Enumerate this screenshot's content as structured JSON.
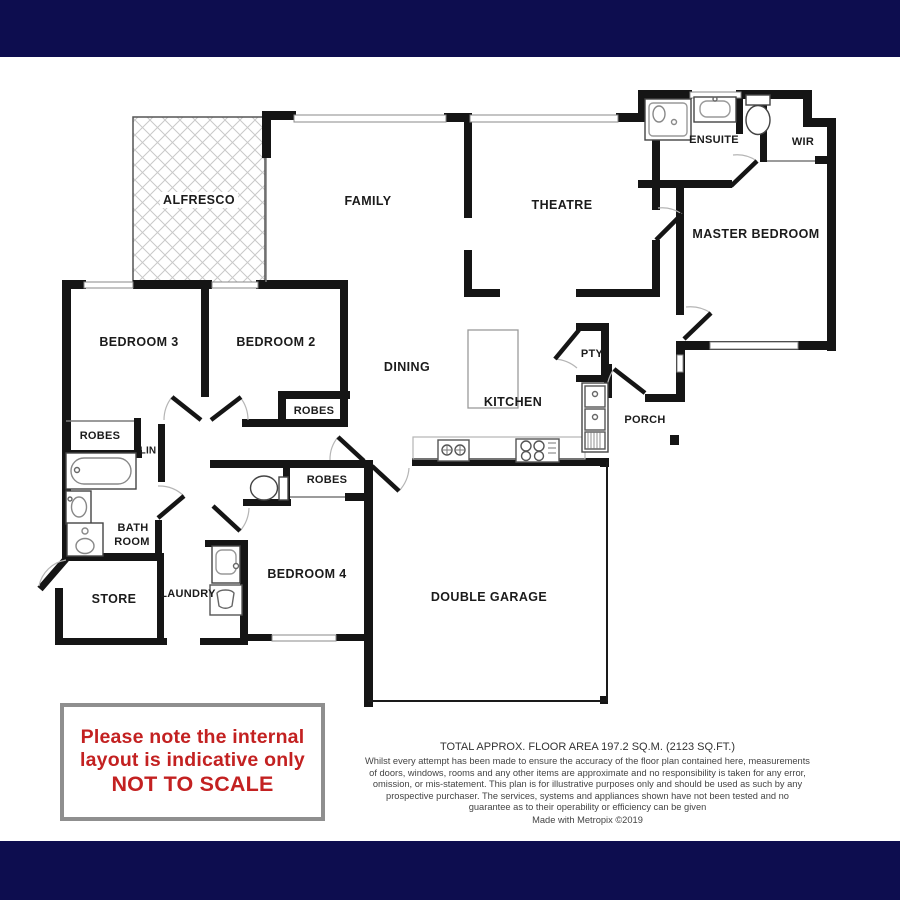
{
  "colors": {
    "banner": "#0d0d4f",
    "wall": "#151515",
    "notice_red": "#c32121",
    "notice_border": "#8f8f8f"
  },
  "rooms": {
    "alfresco": "ALFRESCO",
    "family": "FAMILY",
    "theatre": "THEATRE",
    "ensuite": "ENSUITE",
    "wir": "WIR",
    "master_bedroom": "MASTER BEDROOM",
    "bedroom3": "BEDROOM 3",
    "bedroom2": "BEDROOM 2",
    "dining": "DINING",
    "kitchen": "KITCHEN",
    "pty": "PTY",
    "porch": "PORCH",
    "robes_bed3": "ROBES",
    "robes_bed2": "ROBES",
    "robes_bed4": "ROBES",
    "lin": "LIN",
    "bath_line1": "BATH",
    "bath_line2": "ROOM",
    "store": "STORE",
    "laundry": "LAUNDRY",
    "bedroom4": "BEDROOM 4",
    "double_garage": "DOUBLE GARAGE"
  },
  "fixtures": [
    "bathtub",
    "shower",
    "vanity",
    "toilet",
    "kitchen-sink",
    "cooktop",
    "oven-tower",
    "kitchen-island",
    "laundry-tub",
    "washing-machine",
    "porch-post"
  ],
  "notice": {
    "line1": "Please note the internal",
    "line2": "layout is indicative only",
    "line3": "NOT TO SCALE"
  },
  "disclaimer": {
    "title": "TOTAL APPROX. FLOOR AREA 197.2 SQ.M. (2123 SQ.FT.)",
    "body": "Whilst every attempt has been made to ensure the accuracy of the floor plan contained here, measurements of doors, windows, rooms and any other items are approximate and no responsibility is taken for any error, omission, or mis-statement. This plan is for illustrative purposes only and should be used as such by any prospective purchaser. The services, systems and appliances shown have not been tested and no guarantee as to their operability or efficiency can be given",
    "credit": "Made with Metropix ©2019"
  }
}
